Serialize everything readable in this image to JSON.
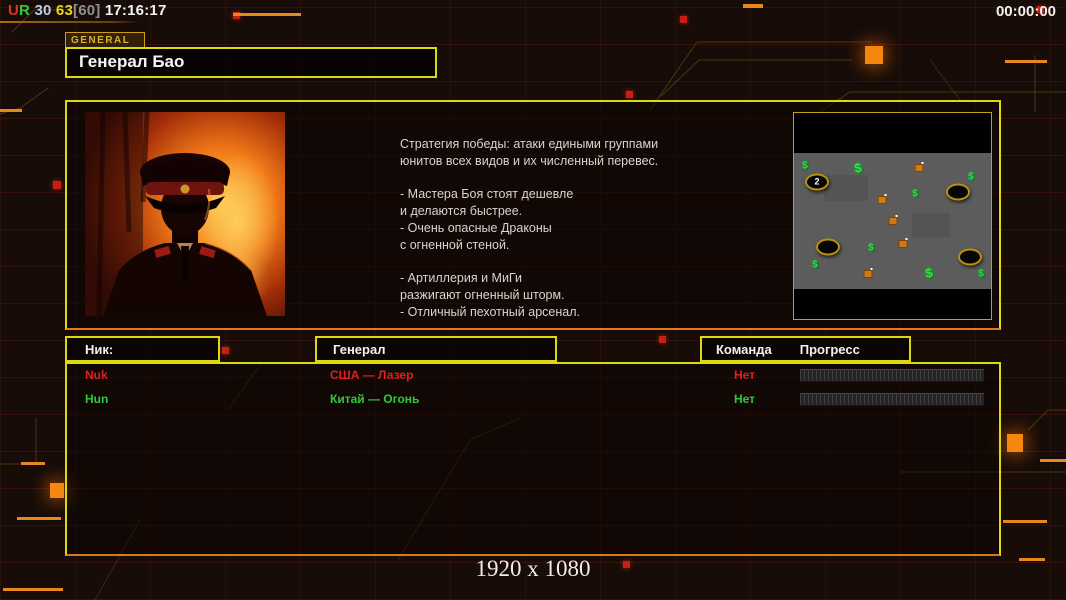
{
  "colors": {
    "accent_yellow": "#dcd90e",
    "accent_orange": "#f08818",
    "alert_red": "#e02020",
    "ally_green": "#30c840"
  },
  "hud": {
    "top_left_segments": [
      {
        "text": "U",
        "color": "#e23022"
      },
      {
        "text": "R",
        "color": "#35c93a"
      },
      {
        "text": " 30",
        "color": "#b9cfe4"
      },
      {
        "text": " 63",
        "color": "#ead81c"
      },
      {
        "text": "[60]",
        "color": "#8f8f8f"
      },
      {
        "text": " 17:16:17",
        "color": "#f2f2f2"
      }
    ],
    "match_timer": "00:00:00"
  },
  "general_panel": {
    "tab_label": "GENERAL",
    "title": "Генерал Бао",
    "description_lines": [
      "Стратегия победы: атаки едиными группами",
      "юнитов всех видов и их численный перевес.",
      "",
      "- Мастера Боя стоят дешевле",
      "и делаются быстрее.",
      "- Очень опасные Драконы",
      "с огненной стеной.",
      "",
      "- Артиллерия и МиГи",
      "разжигают огненный шторм.",
      "- Отличный пехотный арсенал."
    ]
  },
  "minimap": {
    "supply_symbol": "$",
    "items": [
      {
        "type": "supply",
        "x": 11,
        "y": 53
      },
      {
        "type": "start",
        "x": 23,
        "y": 69,
        "label": "2"
      },
      {
        "type": "supply2",
        "x": 64,
        "y": 55
      },
      {
        "type": "tech",
        "x": 125,
        "y": 55
      },
      {
        "type": "supply",
        "x": 177,
        "y": 64
      },
      {
        "type": "start",
        "x": 164,
        "y": 79,
        "label": ""
      },
      {
        "type": "supply",
        "x": 121,
        "y": 81
      },
      {
        "type": "tech",
        "x": 88,
        "y": 87
      },
      {
        "type": "tech",
        "x": 99,
        "y": 108
      },
      {
        "type": "tech",
        "x": 109,
        "y": 131
      },
      {
        "type": "start",
        "x": 34,
        "y": 134,
        "label": ""
      },
      {
        "type": "supply",
        "x": 77,
        "y": 135
      },
      {
        "type": "supply",
        "x": 21,
        "y": 152
      },
      {
        "type": "tech",
        "x": 74,
        "y": 161
      },
      {
        "type": "supply2",
        "x": 135,
        "y": 160
      },
      {
        "type": "start",
        "x": 176,
        "y": 144,
        "label": ""
      },
      {
        "type": "supply",
        "x": 187,
        "y": 161
      }
    ]
  },
  "players_table": {
    "headers": {
      "nick": "Ник:",
      "general": "Генерал",
      "team": "Команда",
      "progress": "Прогресс"
    },
    "rows": [
      {
        "nick": "Nuk",
        "general": "США — Лазер",
        "team": "Нет",
        "color": "#e02020",
        "progress_percent": 0
      },
      {
        "nick": "Hun",
        "general": "Китай — Огонь",
        "team": "Нет",
        "color": "#30c840",
        "progress_percent": 0
      }
    ]
  },
  "footer": {
    "resolution": "1920 x 1080"
  }
}
